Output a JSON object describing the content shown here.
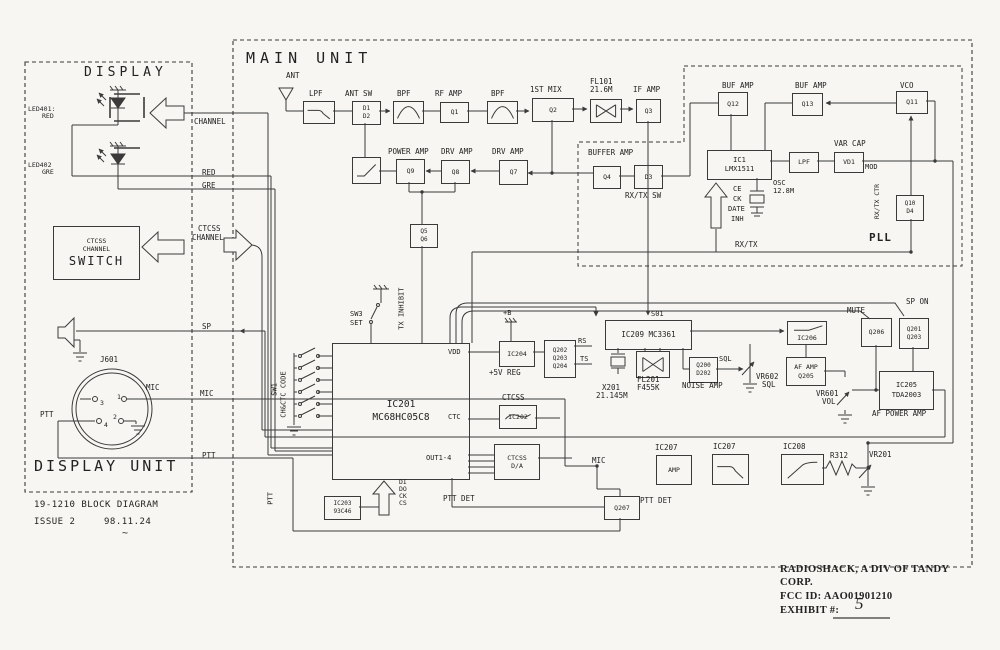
{
  "meta": {
    "description": "Scanned block diagram page",
    "colors": {
      "ink": "#3a3a3a",
      "paper": "#f7f6f2",
      "text": "#222222"
    }
  },
  "display_unit": {
    "title": "DISPLAY",
    "unit_title": "DISPLAY UNIT",
    "doc_line": "19-1210 BLOCK DIAGRAM",
    "issue": "ISSUE 2",
    "date": "98.11.24"
  },
  "main_unit": {
    "title": "MAIN UNIT",
    "pll": "PLL"
  },
  "footer_right": {
    "company1": "RADIOSHACK, A DIV OF TANDY",
    "company2": "CORP.",
    "fcc": "FCC ID: AAO01901210",
    "exhibit": "EXHIBIT #:",
    "exhibit_value": "5"
  },
  "labels": [
    {
      "n": "display-title",
      "t": "DISPLAY",
      "x": 84,
      "y": 66,
      "fs": 13,
      "ls": 4
    },
    {
      "n": "led401-ref",
      "t": "LED401:",
      "x": 28,
      "y": 106,
      "fs": 6.5
    },
    {
      "n": "led401-color",
      "t": "RED",
      "x": 42,
      "y": 113,
      "fs": 6.5
    },
    {
      "n": "led402-ref",
      "t": "LED402",
      "x": 28,
      "y": 162,
      "fs": 6.5
    },
    {
      "n": "led402-color",
      "t": "GRE",
      "x": 42,
      "y": 169,
      "fs": 6.5
    },
    {
      "n": "connector-ref",
      "t": "J601",
      "x": 100,
      "y": 356,
      "fs": 7.5
    },
    {
      "n": "mic-pin-label",
      "t": "MIC",
      "x": 146,
      "y": 384,
      "fs": 7.5
    },
    {
      "n": "ptt-pin-label",
      "t": "PTT",
      "x": 40,
      "y": 411,
      "fs": 7.5
    },
    {
      "n": "pin-3",
      "t": "3",
      "x": 100,
      "y": 400,
      "fs": 6.5
    },
    {
      "n": "pin-1",
      "t": "1",
      "x": 117,
      "y": 394,
      "fs": 6.5
    },
    {
      "n": "pin-4",
      "t": "4",
      "x": 104,
      "y": 422,
      "fs": 6.5
    },
    {
      "n": "pin-2",
      "t": "2",
      "x": 113,
      "y": 414,
      "fs": 6.5
    },
    {
      "n": "display-unit-title",
      "t": "DISPLAY UNIT",
      "x": 34,
      "y": 458,
      "fs": 15,
      "ls": 3
    },
    {
      "n": "model-line",
      "t": "19-1210 BLOCK DIAGRAM",
      "x": 34,
      "y": 501,
      "fs": 9,
      "ls": 0.5
    },
    {
      "n": "issue-label",
      "t": "ISSUE 2",
      "x": 34,
      "y": 518,
      "fs": 9,
      "ls": 0.5
    },
    {
      "n": "issue-date",
      "t": "98.11.24",
      "x": 104,
      "y": 518,
      "fs": 9,
      "ls": 0.5
    },
    {
      "n": "tilde-mark",
      "t": "~",
      "x": 122,
      "y": 528,
      "fs": 10
    },
    {
      "n": "sig-channel",
      "t": "CHANNEL",
      "x": 194,
      "y": 118,
      "fs": 7.5
    },
    {
      "n": "sig-red",
      "t": "RED",
      "x": 202,
      "y": 169,
      "fs": 7.5
    },
    {
      "n": "sig-gre",
      "t": "GRE",
      "x": 202,
      "y": 182,
      "fs": 7.5
    },
    {
      "n": "sig-ctcss-1",
      "t": "CTCSS",
      "x": 198,
      "y": 225,
      "fs": 7.5
    },
    {
      "n": "sig-ctcss-2",
      "t": "CHANNEL",
      "x": 192,
      "y": 234,
      "fs": 7.5
    },
    {
      "n": "sig-sp",
      "t": "SP",
      "x": 202,
      "y": 323,
      "fs": 7.5
    },
    {
      "n": "sig-mic",
      "t": "MIC",
      "x": 200,
      "y": 390,
      "fs": 7.5
    },
    {
      "n": "sig-ptt",
      "t": "PTT",
      "x": 202,
      "y": 452,
      "fs": 7.5
    },
    {
      "n": "main-title",
      "t": "MAIN UNIT",
      "x": 246,
      "y": 50,
      "fs": 15,
      "ls": 5
    },
    {
      "n": "ant-label",
      "t": "ANT",
      "x": 286,
      "y": 72,
      "fs": 7.5
    },
    {
      "n": "lpf-label",
      "t": "LPF",
      "x": 309,
      "y": 90,
      "fs": 7.5
    },
    {
      "n": "ant-sw-label",
      "t": "ANT SW",
      "x": 345,
      "y": 90,
      "fs": 7.5
    },
    {
      "n": "bpf1-label",
      "t": "BPF",
      "x": 397,
      "y": 90,
      "fs": 7.5
    },
    {
      "n": "rf-amp-label",
      "t": "RF AMP",
      "x": 435,
      "y": 90,
      "fs": 7.5
    },
    {
      "n": "bpf2-label",
      "t": "BPF",
      "x": 491,
      "y": 90,
      "fs": 7.5
    },
    {
      "n": "first-mix-label",
      "t": "1ST MIX",
      "x": 530,
      "y": 86,
      "fs": 7.5
    },
    {
      "n": "fl101-ref",
      "t": "FL101",
      "x": 590,
      "y": 78,
      "fs": 7.5
    },
    {
      "n": "fl101-freq",
      "t": "21.6M",
      "x": 590,
      "y": 86,
      "fs": 7.5
    },
    {
      "n": "if-amp-label",
      "t": "IF AMP",
      "x": 633,
      "y": 86,
      "fs": 7.5
    },
    {
      "n": "power-amp-label",
      "t": "POWER AMP",
      "x": 388,
      "y": 148,
      "fs": 7.5
    },
    {
      "n": "drv-amp1-label",
      "t": "DRV AMP",
      "x": 441,
      "y": 148,
      "fs": 7.5
    },
    {
      "n": "drv-amp2-label",
      "t": "DRV AMP",
      "x": 492,
      "y": 148,
      "fs": 7.5
    },
    {
      "n": "buffer-amp-label",
      "t": "BUFFER AMP",
      "x": 588,
      "y": 149,
      "fs": 7.5
    },
    {
      "n": "rx-tx-sw-label",
      "t": "RX/TX SW",
      "x": 625,
      "y": 192,
      "fs": 7.5
    },
    {
      "n": "buf-amp1-label",
      "t": "BUF AMP",
      "x": 722,
      "y": 82,
      "fs": 7.5
    },
    {
      "n": "buf-amp2-label",
      "t": "BUF AMP",
      "x": 795,
      "y": 82,
      "fs": 7.5
    },
    {
      "n": "vco-label",
      "t": "VCO",
      "x": 900,
      "y": 82,
      "fs": 7.5
    },
    {
      "n": "var-cap-label",
      "t": "VAR CAP",
      "x": 834,
      "y": 140,
      "fs": 7.5
    },
    {
      "n": "mod-label",
      "t": "MOD",
      "x": 865,
      "y": 164,
      "fs": 7
    },
    {
      "n": "osc-label",
      "t": "OSC",
      "x": 773,
      "y": 180,
      "fs": 7
    },
    {
      "n": "osc-freq",
      "t": "12.8M",
      "x": 773,
      "y": 188,
      "fs": 7
    },
    {
      "n": "ce-label",
      "t": "CE",
      "x": 733,
      "y": 186,
      "fs": 7
    },
    {
      "n": "ck-label",
      "t": "CK",
      "x": 733,
      "y": 196,
      "fs": 7
    },
    {
      "n": "data-label",
      "t": "DATE",
      "x": 728,
      "y": 206,
      "fs": 7
    },
    {
      "n": "inh-label",
      "t": "INH",
      "x": 731,
      "y": 216,
      "fs": 7
    },
    {
      "n": "rx-tx-ctr-label",
      "t": "RX/TX CTR",
      "x": 881,
      "y": 212,
      "fs": 6.5,
      "v": 1
    },
    {
      "n": "pll-label",
      "t": "PLL",
      "x": 869,
      "y": 232,
      "fs": 11,
      "b": 1,
      "ls": 1
    },
    {
      "n": "rx-tx-label",
      "t": "RX/TX",
      "x": 735,
      "y": 241,
      "fs": 7.5
    },
    {
      "n": "sw3-label",
      "t": "SW3",
      "x": 350,
      "y": 311,
      "fs": 7
    },
    {
      "n": "set-label",
      "t": "SET",
      "x": 350,
      "y": 320,
      "fs": 7
    },
    {
      "n": "tx-inhibit-label",
      "t": "TX INHIBIT",
      "x": 406,
      "y": 322,
      "fs": 7,
      "v": 1
    },
    {
      "n": "sw1-label",
      "t": "SW1",
      "x": 279,
      "y": 388,
      "fs": 7,
      "v": 1
    },
    {
      "n": "ch-ctc-code-label",
      "t": "CH&CTC CODE",
      "x": 288,
      "y": 410,
      "fs": 7,
      "v": 1
    },
    {
      "n": "vdd-pin",
      "t": "VDD",
      "x": 448,
      "y": 349,
      "fs": 7
    },
    {
      "n": "ctc-pin",
      "t": "CTC",
      "x": 448,
      "y": 414,
      "fs": 7
    },
    {
      "n": "out1-4-pin",
      "t": "OUT1-4",
      "x": 426,
      "y": 455,
      "fs": 7
    },
    {
      "n": "plus-b-label",
      "t": "+B",
      "x": 503,
      "y": 310,
      "fs": 7
    },
    {
      "n": "reg-5v-label",
      "t": "+5V REG",
      "x": 489,
      "y": 369,
      "fs": 7.5
    },
    {
      "n": "rs-label",
      "t": "RS",
      "x": 578,
      "y": 338,
      "fs": 7
    },
    {
      "n": "ts-label",
      "t": "TS",
      "x": 580,
      "y": 356,
      "fs": 7
    },
    {
      "n": "ctcss-ic202-label",
      "t": "CTCSS",
      "x": 502,
      "y": 394,
      "fs": 7.5
    },
    {
      "n": "ptt-det-label-1",
      "t": "PTT DET",
      "x": 443,
      "y": 495,
      "fs": 7.5
    },
    {
      "n": "di-label",
      "t": "DI",
      "x": 399,
      "y": 479,
      "fs": 6.5
    },
    {
      "n": "do-label",
      "t": "DO",
      "x": 399,
      "y": 486,
      "fs": 6.5
    },
    {
      "n": "ck2-label",
      "t": "CK",
      "x": 399,
      "y": 493,
      "fs": 6.5
    },
    {
      "n": "cs-label",
      "t": "CS",
      "x": 399,
      "y": 500,
      "fs": 6.5
    },
    {
      "n": "s01-label",
      "t": "S01",
      "x": 651,
      "y": 311,
      "fs": 7
    },
    {
      "n": "x201-ref",
      "t": "X201",
      "x": 602,
      "y": 384,
      "fs": 7.5
    },
    {
      "n": "x201-freq",
      "t": "21.145M",
      "x": 596,
      "y": 392,
      "fs": 7.5
    },
    {
      "n": "fl201-ref",
      "t": "FL201",
      "x": 637,
      "y": 376,
      "fs": 7.5
    },
    {
      "n": "fl201-type",
      "t": "F455K",
      "x": 637,
      "y": 384,
      "fs": 7.5
    },
    {
      "n": "noise-amp-label",
      "t": "NOISE AMP",
      "x": 682,
      "y": 382,
      "fs": 7.5
    },
    {
      "n": "sql-label",
      "t": "SQL",
      "x": 719,
      "y": 356,
      "fs": 7
    },
    {
      "n": "vr602-ref",
      "t": "VR602",
      "x": 756,
      "y": 373,
      "fs": 7.5
    },
    {
      "n": "vr602-func",
      "t": "SQL",
      "x": 762,
      "y": 381,
      "fs": 7.5
    },
    {
      "n": "mute-label",
      "t": "MUTE",
      "x": 847,
      "y": 307,
      "fs": 7.5
    },
    {
      "n": "sp-on-label",
      "t": "SP ON",
      "x": 906,
      "y": 298,
      "fs": 7.5
    },
    {
      "n": "vr601-ref",
      "t": "VR601",
      "x": 816,
      "y": 390,
      "fs": 7.5
    },
    {
      "n": "vr601-func",
      "t": "VOL",
      "x": 822,
      "y": 398,
      "fs": 7.5
    },
    {
      "n": "af-power-amp-label",
      "t": "AF POWER AMP",
      "x": 872,
      "y": 410,
      "fs": 7.5
    },
    {
      "n": "mic-node-label",
      "t": "MIC",
      "x": 592,
      "y": 457,
      "fs": 7.5
    },
    {
      "n": "ic207a-label",
      "t": "IC207",
      "x": 655,
      "y": 444,
      "fs": 7.5
    },
    {
      "n": "ic207b-label",
      "t": "IC207",
      "x": 713,
      "y": 443,
      "fs": 7.5
    },
    {
      "n": "ic208-label",
      "t": "IC208",
      "x": 783,
      "y": 443,
      "fs": 7.5
    },
    {
      "n": "r312-label",
      "t": "R312",
      "x": 830,
      "y": 452,
      "fs": 7.5
    },
    {
      "n": "vr201-label",
      "t": "VR201",
      "x": 869,
      "y": 451,
      "fs": 7.5
    },
    {
      "n": "ptt-det-label-2",
      "t": "PTT DET",
      "x": 640,
      "y": 497,
      "fs": 7.5
    },
    {
      "n": "ptt-vert-label",
      "t": "PTT",
      "x": 275,
      "y": 497,
      "fs": 7,
      "v": 1
    },
    {
      "n": "footer-company-1",
      "t": "RADIOSHACK, A DIV OF TANDY",
      "x": 780,
      "y": 564,
      "fs": 10.5,
      "f": 1,
      "b": 1
    },
    {
      "n": "footer-company-2",
      "t": "CORP.",
      "x": 780,
      "y": 577,
      "fs": 10.5,
      "f": 1,
      "b": 1
    },
    {
      "n": "footer-fcc-id",
      "t": "FCC ID: AAO01901210",
      "x": 780,
      "y": 591,
      "fs": 10.5,
      "f": 1,
      "b": 1
    },
    {
      "n": "footer-exhibit",
      "t": "EXHIBIT #:",
      "x": 780,
      "y": 605,
      "fs": 10.5,
      "f": 1,
      "b": 1
    },
    {
      "n": "exhibit-value",
      "t": "5",
      "x": 855,
      "y": 595,
      "fs": 17,
      "f": 1,
      "i": 1
    }
  ],
  "boxes": [
    {
      "n": "ctcss-switch-box",
      "x": 53,
      "y": 226,
      "w": 85,
      "h": 52,
      "lines": [
        "CTCSS",
        "CHANNEL",
        "SWITCH"
      ],
      "fs": 6.5,
      "bigLast": 1
    },
    {
      "n": "lpf-box",
      "x": 303,
      "y": 101,
      "w": 30,
      "h": 21,
      "sym": "lp"
    },
    {
      "n": "ant-sw-box",
      "x": 352,
      "y": 101,
      "w": 27,
      "h": 22,
      "lines": [
        "D1",
        "D2"
      ],
      "fs": 6
    },
    {
      "n": "bpf1-box",
      "x": 393,
      "y": 101,
      "w": 29,
      "h": 21,
      "sym": "bp"
    },
    {
      "n": "rf-amp-box",
      "x": 440,
      "y": 102,
      "w": 27,
      "h": 19,
      "lines": [
        "Q1"
      ],
      "fs": 6.5
    },
    {
      "n": "bpf2-box",
      "x": 487,
      "y": 101,
      "w": 29,
      "h": 21,
      "sym": "bp"
    },
    {
      "n": "first-mix-box",
      "x": 532,
      "y": 98,
      "w": 40,
      "h": 22,
      "lines": [
        "Q2"
      ],
      "fs": 6.5
    },
    {
      "n": "fl101-box",
      "x": 590,
      "y": 99,
      "w": 30,
      "h": 22,
      "sym": "bow"
    },
    {
      "n": "if-amp-box",
      "x": 636,
      "y": 99,
      "w": 23,
      "h": 22,
      "lines": [
        "Q3"
      ],
      "fs": 6.5
    },
    {
      "n": "tx-rx-ant-switch-box",
      "x": 352,
      "y": 157,
      "w": 27,
      "h": 25,
      "sym": "sw"
    },
    {
      "n": "q9-box",
      "x": 396,
      "y": 159,
      "w": 27,
      "h": 23,
      "lines": [
        "Q9"
      ],
      "fs": 6.5
    },
    {
      "n": "q8-box",
      "x": 441,
      "y": 160,
      "w": 27,
      "h": 22,
      "lines": [
        "Q8"
      ],
      "fs": 6.5
    },
    {
      "n": "q7-box",
      "x": 499,
      "y": 160,
      "w": 27,
      "h": 23,
      "lines": [
        "Q7"
      ],
      "fs": 6.5
    },
    {
      "n": "q5-q6-box",
      "x": 410,
      "y": 224,
      "w": 26,
      "h": 22,
      "lines": [
        "Q5",
        "Q6"
      ],
      "fs": 6
    },
    {
      "n": "q4-box",
      "x": 593,
      "y": 166,
      "w": 26,
      "h": 21,
      "lines": [
        "Q4"
      ],
      "fs": 6.5
    },
    {
      "n": "d3-box",
      "x": 634,
      "y": 165,
      "w": 27,
      "h": 22,
      "lines": [
        "D3"
      ],
      "fs": 6.5
    },
    {
      "n": "q12-box",
      "x": 718,
      "y": 92,
      "w": 28,
      "h": 22,
      "lines": [
        "Q12"
      ],
      "fs": 6.5
    },
    {
      "n": "q13-box",
      "x": 792,
      "y": 93,
      "w": 29,
      "h": 21,
      "lines": [
        "Q13"
      ],
      "fs": 6.5
    },
    {
      "n": "q11-box",
      "x": 896,
      "y": 91,
      "w": 30,
      "h": 21,
      "lines": [
        "Q11"
      ],
      "fs": 6.5
    },
    {
      "n": "ic1-box",
      "x": 707,
      "y": 150,
      "w": 63,
      "h": 28,
      "lines": [
        "IC1",
        "LMX1511"
      ],
      "fs": 7
    },
    {
      "n": "pll-lpf-box",
      "x": 789,
      "y": 152,
      "w": 28,
      "h": 19,
      "lines": [
        "LPF"
      ],
      "fs": 6.5
    },
    {
      "n": "vd1-box",
      "x": 834,
      "y": 152,
      "w": 28,
      "h": 19,
      "lines": [
        "VD1"
      ],
      "fs": 6.5
    },
    {
      "n": "q10-d4-box",
      "x": 896,
      "y": 195,
      "w": 26,
      "h": 24,
      "lines": [
        "Q10",
        "D4"
      ],
      "fs": 6
    },
    {
      "n": "ic201-box",
      "x": 332,
      "y": 343,
      "w": 136,
      "h": 135,
      "lines": [
        "IC201",
        "MC68HC05C8"
      ],
      "fs": 9.5
    },
    {
      "n": "ic204-box",
      "x": 499,
      "y": 341,
      "w": 34,
      "h": 24,
      "lines": [
        "IC204"
      ],
      "fs": 6.5
    },
    {
      "n": "q202-box",
      "x": 544,
      "y": 340,
      "w": 30,
      "h": 36,
      "lines": [
        "Q202",
        "Q203",
        "Q204"
      ],
      "fs": 6
    },
    {
      "n": "ic202-box",
      "x": 499,
      "y": 405,
      "w": 36,
      "h": 22,
      "lines": [
        "IC202"
      ],
      "sym": "wave",
      "fs": 6.5
    },
    {
      "n": "ctcss-da-box",
      "x": 494,
      "y": 444,
      "w": 44,
      "h": 34,
      "lines": [
        "CTCSS",
        "D/A"
      ],
      "fs": 6.5
    },
    {
      "n": "ic203-box",
      "x": 324,
      "y": 496,
      "w": 35,
      "h": 22,
      "lines": [
        "IC203",
        "93C46"
      ],
      "fs": 6
    },
    {
      "n": "ic209-box",
      "x": 605,
      "y": 320,
      "w": 85,
      "h": 28,
      "lines": [
        "IC209 MC3361"
      ],
      "fs": 7.5
    },
    {
      "n": "fl201-box",
      "x": 636,
      "y": 351,
      "w": 32,
      "h": 25,
      "sym": "bow"
    },
    {
      "n": "noise-amp-box",
      "x": 689,
      "y": 357,
      "w": 27,
      "h": 24,
      "lines": [
        "Q200",
        "D202"
      ],
      "fs": 6
    },
    {
      "n": "ic206-box",
      "x": 787,
      "y": 321,
      "w": 40,
      "h": 24,
      "lines": [
        "IC206"
      ],
      "sym": "lptop",
      "tb": 1,
      "fs": 6.5
    },
    {
      "n": "q206-box",
      "x": 861,
      "y": 318,
      "w": 29,
      "h": 27,
      "lines": [
        "Q206"
      ],
      "fs": 6.5
    },
    {
      "n": "q201-q203-box",
      "x": 899,
      "y": 318,
      "w": 28,
      "h": 29,
      "lines": [
        "Q201",
        "Q203"
      ],
      "fs": 6
    },
    {
      "n": "af-amp-box",
      "x": 786,
      "y": 357,
      "w": 38,
      "h": 27,
      "lines": [
        "AF AMP",
        "Q205"
      ],
      "fs": 6.5
    },
    {
      "n": "ic205-box",
      "x": 879,
      "y": 371,
      "w": 53,
      "h": 37,
      "lines": [
        "IC205",
        "TDA2003"
      ],
      "fs": 7
    },
    {
      "n": "mic-amp-box",
      "x": 656,
      "y": 455,
      "w": 34,
      "h": 28,
      "lines": [
        "AMP"
      ],
      "fs": 6.5
    },
    {
      "n": "ic207-filter-box",
      "x": 712,
      "y": 454,
      "w": 35,
      "h": 29,
      "sym": "lp"
    },
    {
      "n": "ic208-filter-box",
      "x": 781,
      "y": 454,
      "w": 41,
      "h": 29,
      "sym": "hp"
    },
    {
      "n": "q207-box",
      "x": 604,
      "y": 496,
      "w": 34,
      "h": 22,
      "lines": [
        "Q207"
      ],
      "fs": 6.5
    }
  ]
}
